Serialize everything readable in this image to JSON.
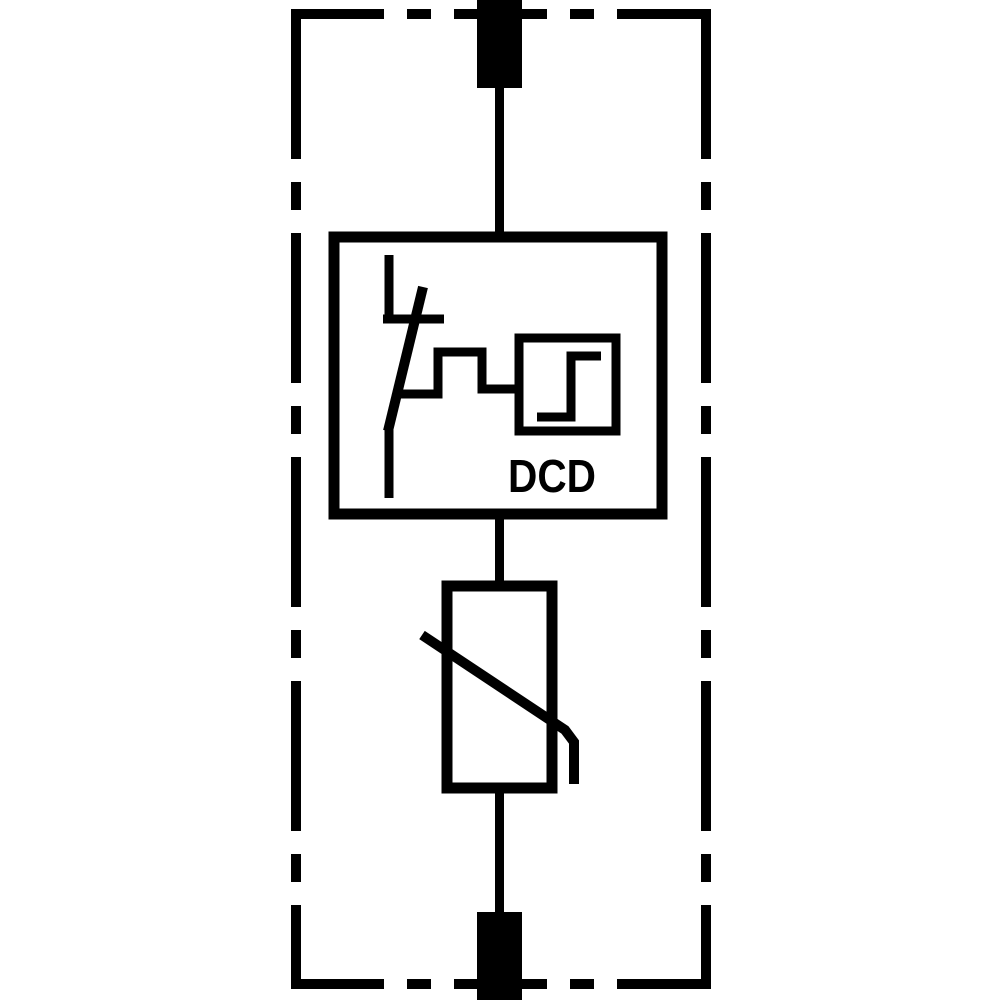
{
  "colors": {
    "line": "#000000",
    "background": "#ffffff"
  },
  "dcd_unit": {
    "label": "DCD"
  },
  "icons": {
    "enclosure_border": "dash-dot-device-boundary",
    "terminal_top": "terminal-stud-icon",
    "terminal_bottom": "terminal-stud-icon",
    "disconnector": "thermal-disconnector-switch-icon",
    "trigger_wave": "pulse-signal-line-icon",
    "trigger_box": "step-function-trigger-icon",
    "varistor": "varistor-icon"
  }
}
